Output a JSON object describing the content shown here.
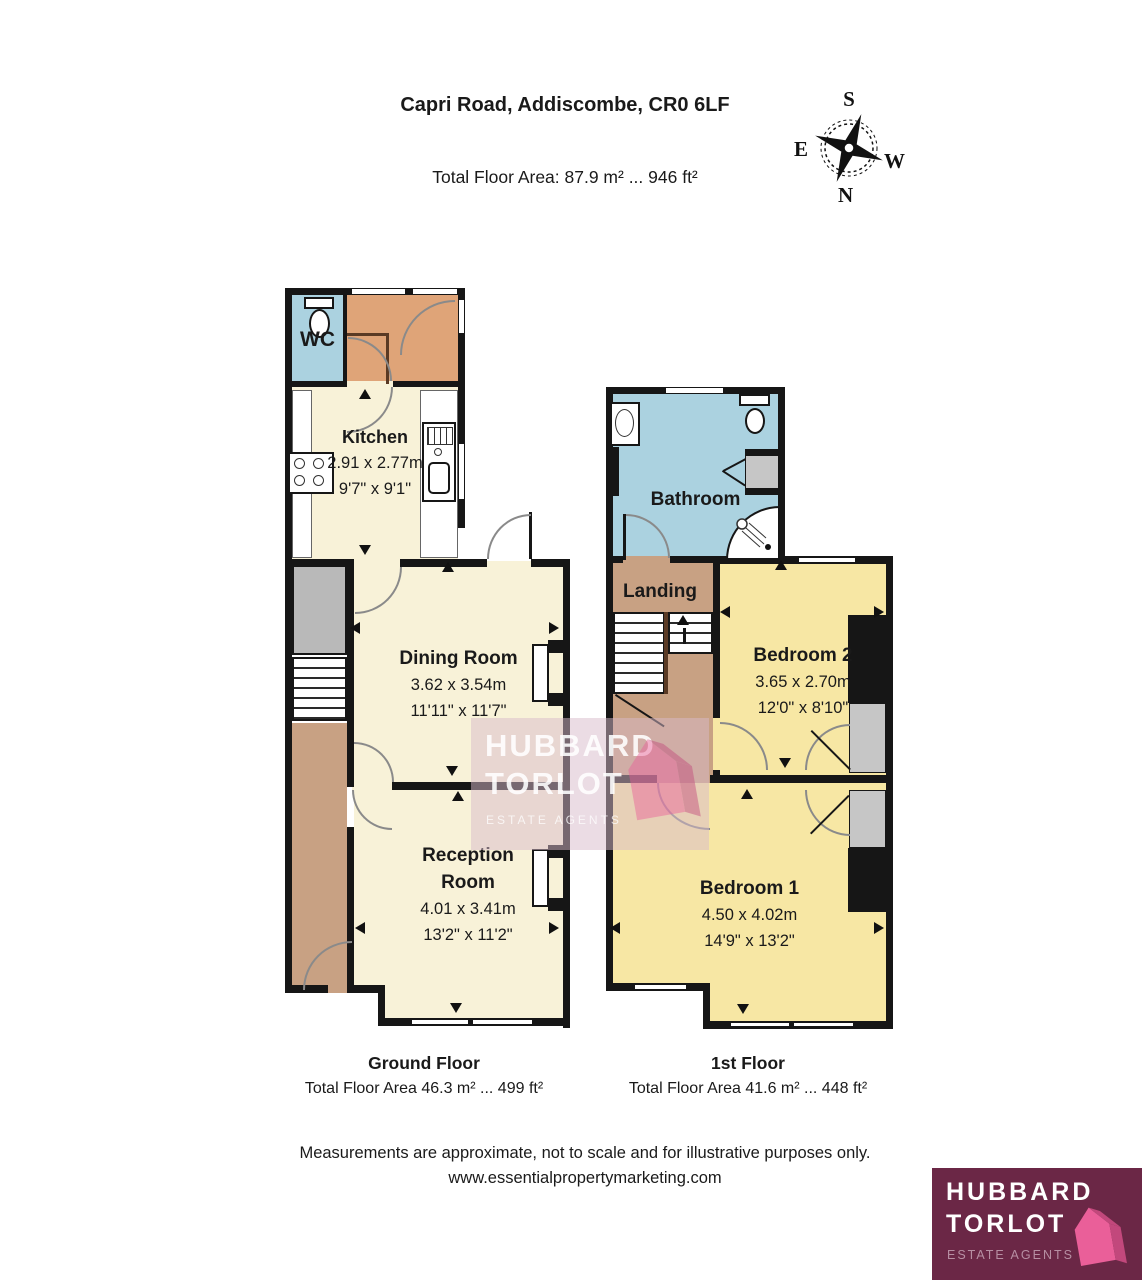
{
  "header": {
    "title": "Capri Road, Addiscombe, CR0 6LF",
    "total_area": "Total Floor Area: 87.9 m² ... 946 ft²"
  },
  "compass": {
    "n": "N",
    "s": "S",
    "e": "E",
    "w": "W"
  },
  "ground_floor": {
    "title": "Ground Floor",
    "area": "Total Floor Area 46.3 m² ... 499 ft²",
    "rooms": {
      "wc": {
        "name": "WC"
      },
      "kitchen": {
        "name": "Kitchen",
        "metric": "2.91 x 2.77m",
        "imperial": "9'7\" x 9'1\""
      },
      "dining": {
        "name": "Dining Room",
        "metric": "3.62 x 3.54m",
        "imperial": "11'11\" x 11'7\""
      },
      "reception": {
        "name": "Reception Room",
        "metric": "4.01 x 3.41m",
        "imperial": "13'2\" x 11'2\""
      }
    }
  },
  "first_floor": {
    "title": "1st Floor",
    "area": "Total Floor Area 41.6 m² ... 448 ft²",
    "rooms": {
      "bathroom": {
        "name": "Bathroom"
      },
      "landing": {
        "name": "Landing"
      },
      "bedroom2": {
        "name": "Bedroom 2",
        "metric": "3.65 x 2.70m",
        "imperial": "12'0\" x 8'10\""
      },
      "bedroom1": {
        "name": "Bedroom 1",
        "metric": "4.50 x 4.02m",
        "imperial": "14'9\" x 13'2\""
      }
    }
  },
  "footer": {
    "disclaimer": "Measurements are approximate, not to scale and for illustrative purposes only.",
    "website": "www.essentialpropertymarketing.com"
  },
  "branding": {
    "watermark": {
      "line1": "HUBBARD",
      "line2": "TORLOT",
      "line3": "ESTATE AGENTS"
    },
    "logo": {
      "line1": "HUBBARD",
      "line2": "TORLOT",
      "tagline": "ESTATE AGENTS"
    }
  },
  "colors": {
    "wall": "#161616",
    "cream": "#f8f2d8",
    "yellow": "#f7e7a4",
    "blue": "#abd2e0",
    "tan": "#dfa478",
    "brown": "#c8a183",
    "gray": "#b9b9b9",
    "logo_maroon": "#6b2746",
    "logo_pink": "#ea5f99",
    "logo_pink_dark": "#c2487c",
    "logo_muted": "#b78fa3"
  }
}
